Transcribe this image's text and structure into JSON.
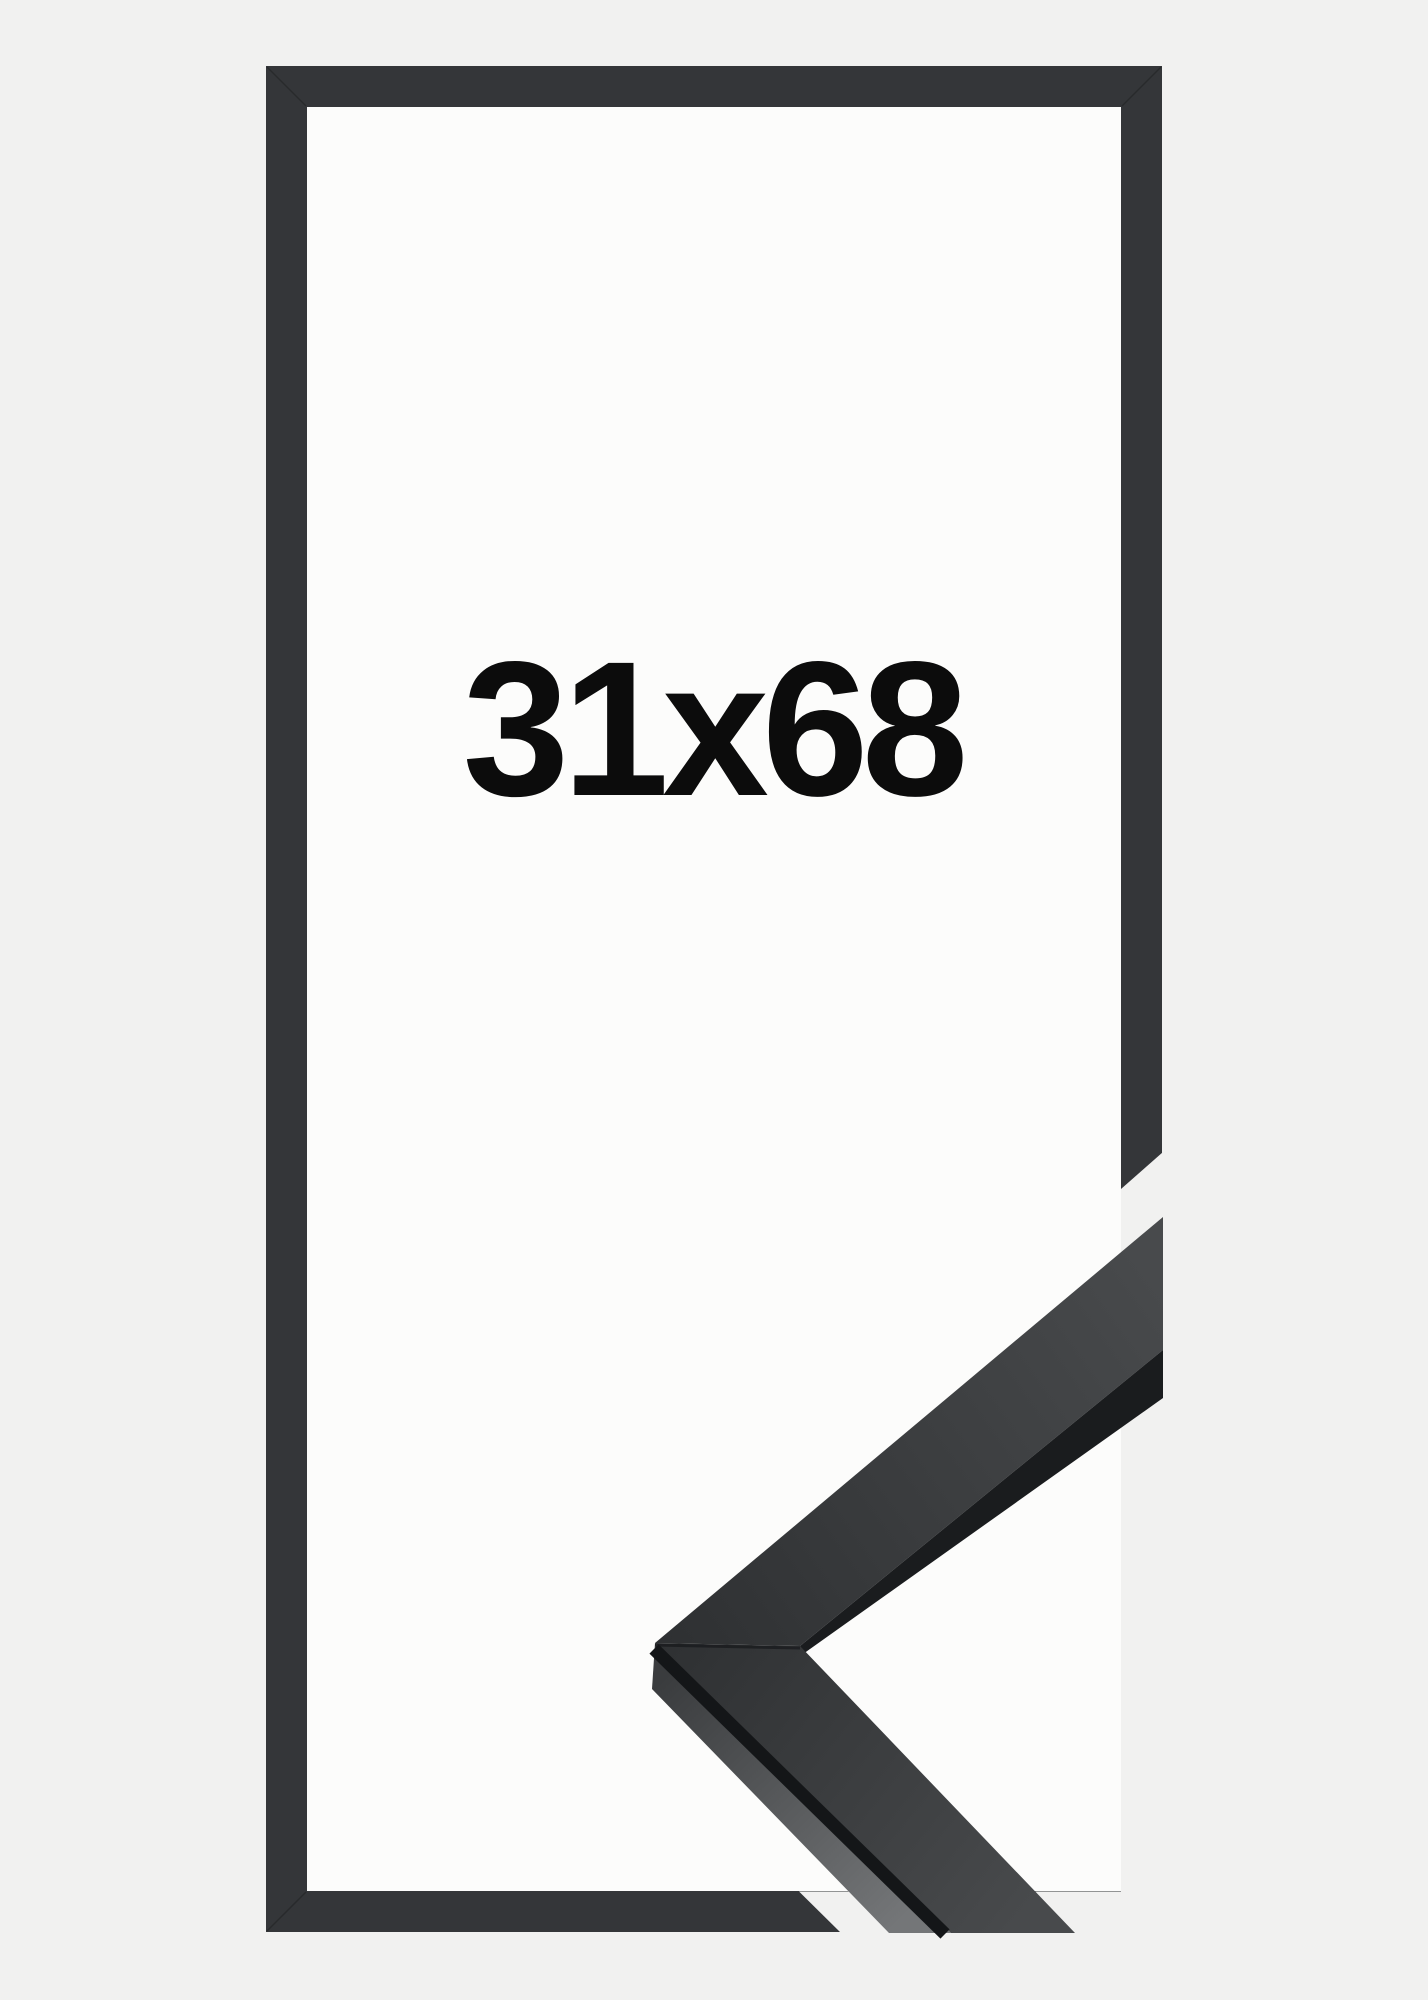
{
  "product_image": {
    "size_label": "31x68"
  },
  "colors": {
    "background": "#f1f1f0",
    "mount": "#fcfcfb",
    "frame_border": "#343639",
    "label_text": "#0c0c0c",
    "corner_face_dark": "#2e3032",
    "corner_face_light": "#484a4c",
    "corner_side_dark": "#3a3c3e",
    "corner_side_light": "#747678",
    "corner_edge_dark": "#1a1c1e",
    "miter_seam": "#141618"
  }
}
